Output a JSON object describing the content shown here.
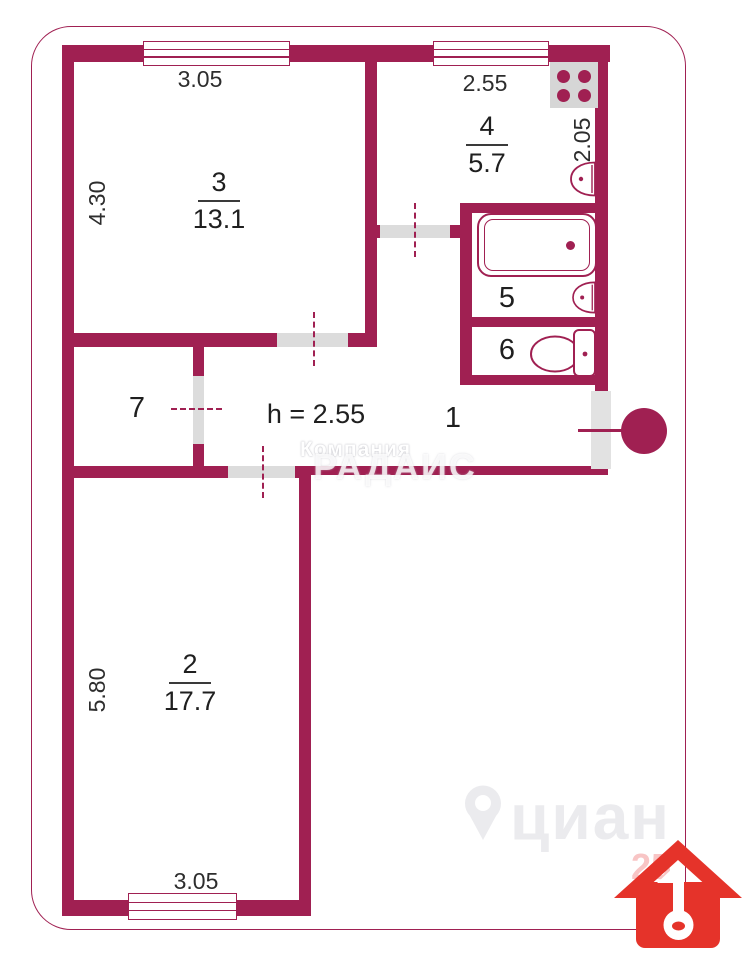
{
  "rooms": {
    "living1": {
      "number": "3",
      "area": "13.1"
    },
    "kitchen": {
      "number": "4",
      "area": "5.7"
    },
    "living2": {
      "number": "2",
      "area": "17.7"
    },
    "bath": "5",
    "wc": "6",
    "closet": "7",
    "hall": "1"
  },
  "labels": {
    "ceiling_height": "h = 2.55"
  },
  "dimensions": {
    "room3_width": "3.05",
    "room3_depth": "4.30",
    "kitchen_width": "2.55",
    "kitchen_depth": "2.05",
    "room2_depth": "5.80",
    "room2_width": "3.05"
  },
  "watermarks": {
    "agency_line1": "Компания",
    "agency_line2": "РАДАИС",
    "cian_logo": "циан",
    "number": "25"
  },
  "icon_names": [
    "stove-icon",
    "kitchen-sink-icon",
    "bathtub-icon",
    "bath-sink-icon",
    "toilet-icon",
    "entry-door-icon",
    "cian-pin-icon",
    "house-key-logo-icon"
  ],
  "colors": {
    "wall": "#a02052",
    "fixture_gray": "#d6d6d6",
    "sill_gray": "#dcdcdc",
    "logo_red": "#e5332a",
    "text": "#2d2d2d"
  }
}
